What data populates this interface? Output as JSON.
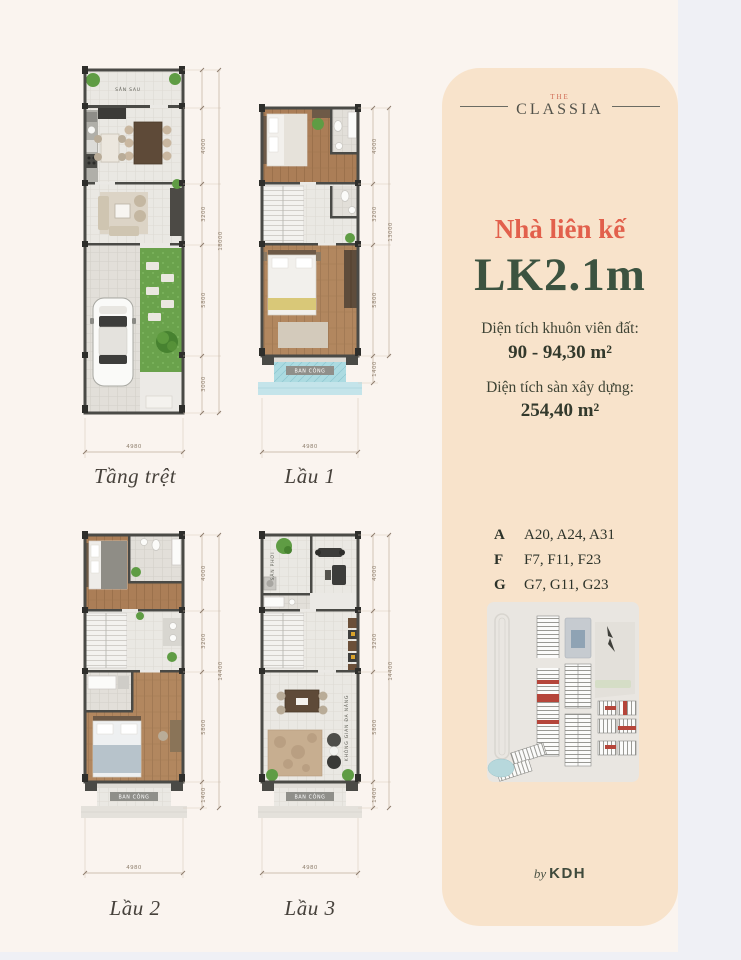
{
  "panel": {
    "brand_the": "THE",
    "brand_name": "CLASSIA",
    "subtitle": "Nhà liên kế",
    "title": "LK2.1m",
    "land_area_label": "Diện tích khuôn viên đất:",
    "land_area_value": "90 - 94,30 m²",
    "floor_area_label": "Diện tích sàn xây dựng:",
    "floor_area_value": "254,40 m²",
    "units": [
      {
        "group": "A",
        "codes": "A20, A24, A31"
      },
      {
        "group": "F",
        "codes": "F7, F11, F23"
      },
      {
        "group": "G",
        "codes": "G7, G11, G23"
      }
    ],
    "byline_by": "by",
    "byline_brand": "KDH",
    "colors": {
      "accent": "#e2604c",
      "green": "#3c5340",
      "panel_bg": "#f8e3cb"
    }
  },
  "plans": {
    "ground": {
      "label": "Tầng trệt",
      "rooms": {
        "back_yard": "SÂN SAU"
      },
      "dims": {
        "d1": "4000",
        "d2": "3200",
        "d3": "5800",
        "d4": "3000",
        "total": "18000",
        "width": "4980"
      }
    },
    "floor1": {
      "label": "Lầu 1",
      "rooms": {
        "balcony": "BAN CÔNG"
      },
      "dims": {
        "d1": "4000",
        "d2": "3200",
        "d3": "5800",
        "d4": "1400",
        "total": "13000",
        "width": "4980"
      }
    },
    "floor2": {
      "label": "Lầu 2",
      "rooms": {
        "balcony": "BAN CÔNG"
      },
      "dims": {
        "d1": "4000",
        "d2": "3200",
        "d3": "5800",
        "d4": "1400",
        "total": "14400",
        "width": "4980"
      }
    },
    "floor3": {
      "label": "Lầu 3",
      "rooms": {
        "drying_yard": "SÂN PHƠI",
        "multipurpose": "KHÔNG GIAN ĐA NĂNG",
        "balcony": "BAN CÔNG"
      },
      "dims": {
        "d1": "4000",
        "d2": "3200",
        "d3": "5800",
        "d4": "1400",
        "total": "14400",
        "width": "4980"
      }
    }
  }
}
